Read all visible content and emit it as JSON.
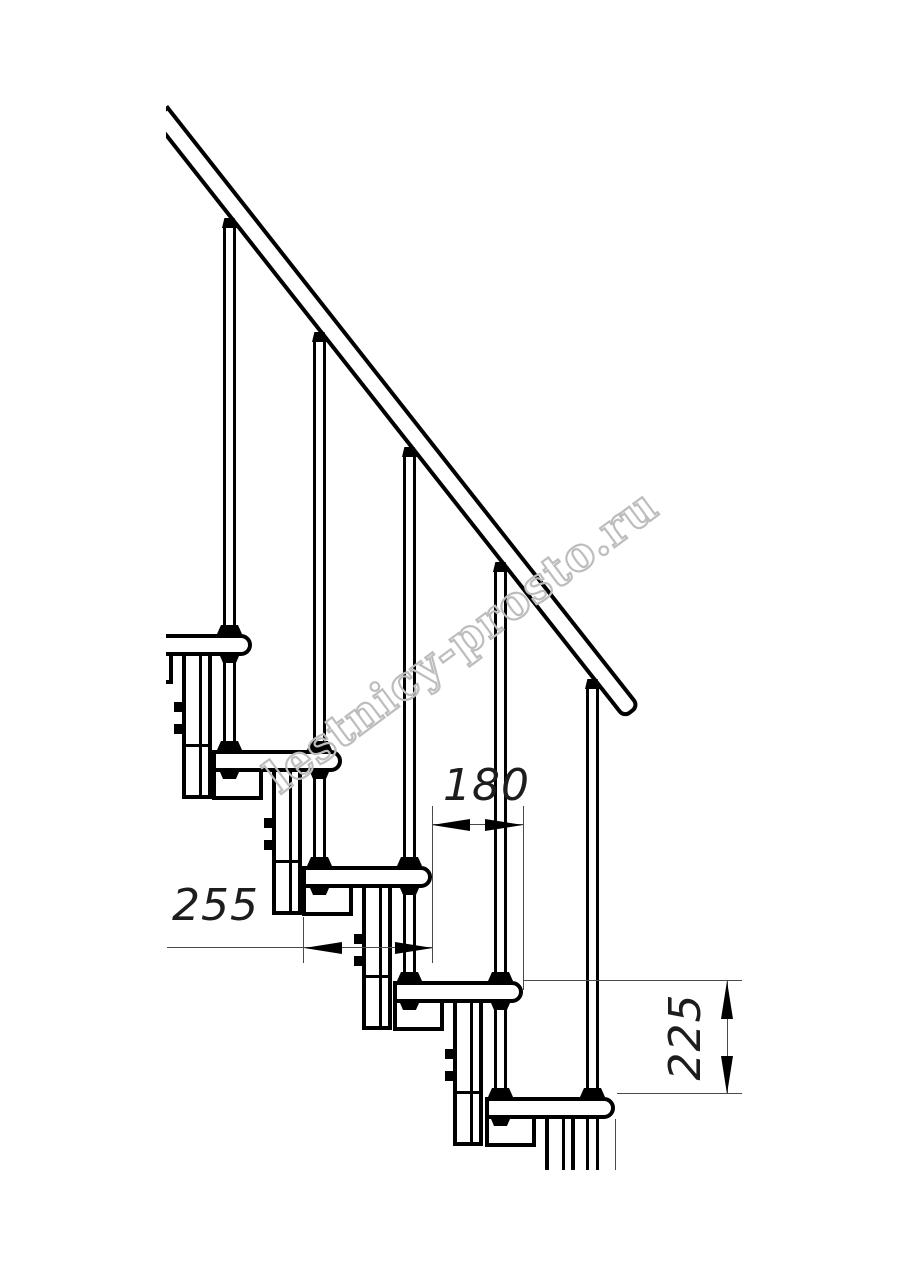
{
  "dimensions": {
    "tread_depth": {
      "label": "255"
    },
    "going": {
      "label": "180"
    },
    "rise": {
      "label": "225"
    }
  },
  "watermark": {
    "text": "lestnicy-prosto.ru",
    "color": "#bdbdbd"
  },
  "colors": {
    "background": "#ffffff",
    "outline": "#000000",
    "thin_line": "#4a4a4a",
    "dim_text": "#1d1d1d"
  }
}
